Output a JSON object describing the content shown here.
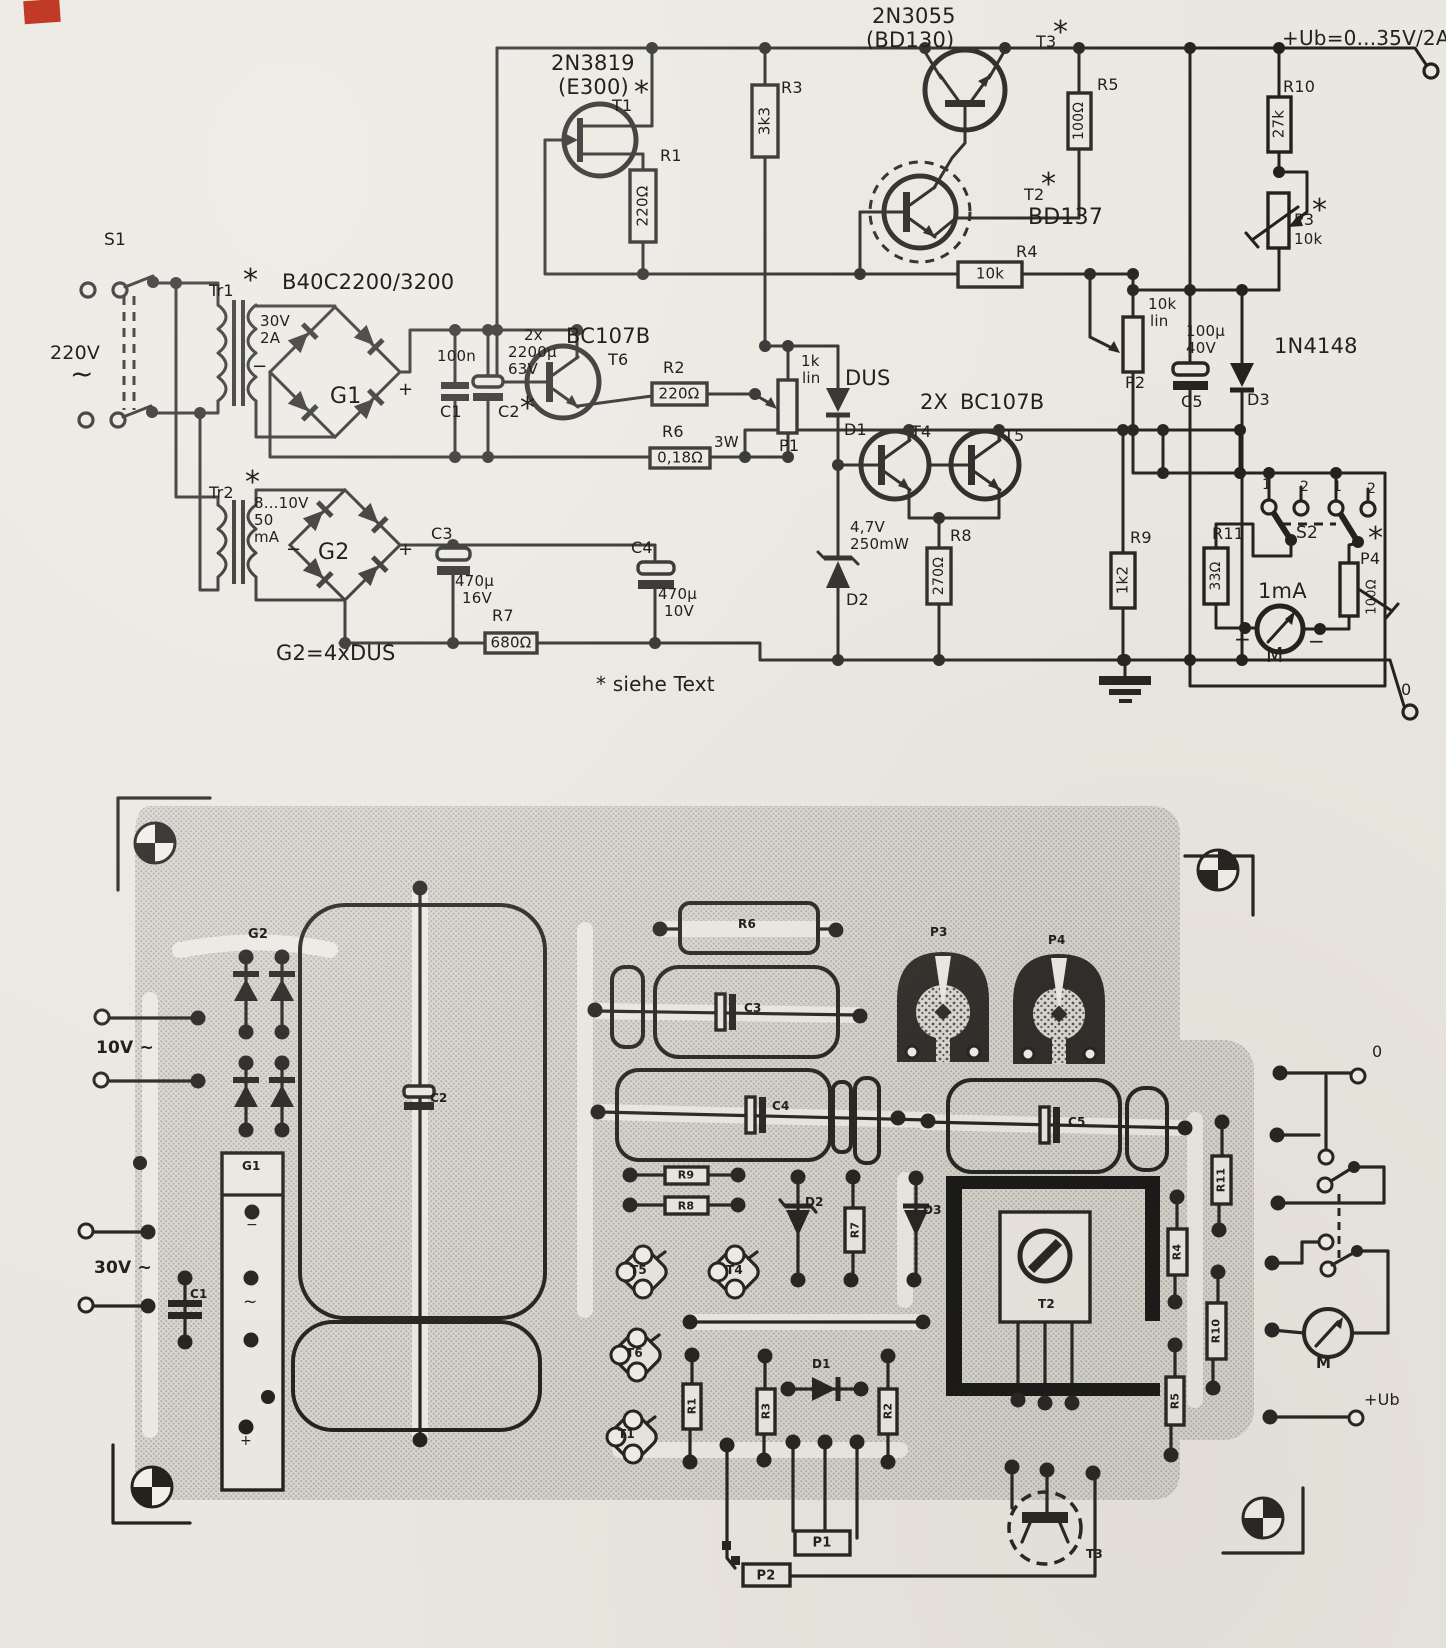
{
  "meta": {
    "content_type": "scanned circuit schematic with PCB layout",
    "paper_color": "#eae7e0",
    "ink_color": "#22211e",
    "board_color": "#d7d5ce",
    "artifact_color": "#c03a25"
  },
  "schematic": {
    "labels": [
      {
        "n": "s1-label",
        "t": "S1",
        "x": 104,
        "y": 232,
        "fs": 17
      },
      {
        "n": "mains-voltage",
        "t": "220V",
        "x": 50,
        "y": 344,
        "fs": 19
      },
      {
        "n": "mains-ac-symbol",
        "t": "~",
        "x": 70,
        "y": 360,
        "fs": 28
      },
      {
        "n": "tr1-label",
        "t": "Tr1",
        "x": 209,
        "y": 283,
        "fs": 16
      },
      {
        "n": "tr1-star",
        "t": "*",
        "x": 243,
        "y": 266,
        "fs": 30
      },
      {
        "n": "tr2-label",
        "t": "Tr2",
        "x": 209,
        "y": 485,
        "fs": 16
      },
      {
        "n": "tr2-star",
        "t": "*",
        "x": 245,
        "y": 468,
        "fs": 30
      },
      {
        "n": "bridge1-part",
        "t": "B40C2200/3200",
        "x": 282,
        "y": 272,
        "fs": 21
      },
      {
        "n": "g1-volt",
        "t": "30V",
        "x": 260,
        "y": 314,
        "fs": 15
      },
      {
        "n": "g1-amp",
        "t": "2A",
        "x": 260,
        "y": 331,
        "fs": 15
      },
      {
        "n": "g1-minus",
        "t": "−",
        "x": 252,
        "y": 358,
        "fs": 18
      },
      {
        "n": "g1-label",
        "t": "G1",
        "x": 330,
        "y": 386,
        "fs": 22
      },
      {
        "n": "g1-plus",
        "t": "+",
        "x": 398,
        "y": 381,
        "fs": 18
      },
      {
        "n": "g2-volt",
        "t": "8...10V",
        "x": 254,
        "y": 496,
        "fs": 15
      },
      {
        "n": "g2-cur",
        "t": "50",
        "x": 254,
        "y": 513,
        "fs": 15
      },
      {
        "n": "g2-cur-unit",
        "t": "mA",
        "x": 254,
        "y": 530,
        "fs": 15
      },
      {
        "n": "g2-minus",
        "t": "−",
        "x": 286,
        "y": 541,
        "fs": 18
      },
      {
        "n": "g2-label",
        "t": "G2",
        "x": 318,
        "y": 542,
        "fs": 22
      },
      {
        "n": "g2-plus",
        "t": "+",
        "x": 398,
        "y": 541,
        "fs": 18
      },
      {
        "n": "c1-value",
        "t": "100n",
        "x": 437,
        "y": 349,
        "fs": 15
      },
      {
        "n": "c1-label",
        "t": "C1",
        "x": 440,
        "y": 404,
        "fs": 16
      },
      {
        "n": "c2-qty",
        "t": "2x",
        "x": 524,
        "y": 328,
        "fs": 15
      },
      {
        "n": "c2-value",
        "t": "2200µ",
        "x": 508,
        "y": 345,
        "fs": 15
      },
      {
        "n": "c2-volt",
        "t": "63V",
        "x": 508,
        "y": 362,
        "fs": 15
      },
      {
        "n": "c2-label",
        "t": "C2",
        "x": 498,
        "y": 404,
        "fs": 16
      },
      {
        "n": "c2-star",
        "t": "*",
        "x": 520,
        "y": 394,
        "fs": 30
      },
      {
        "n": "t6-part",
        "t": "BC107B",
        "x": 566,
        "y": 326,
        "fs": 21
      },
      {
        "n": "t6-label",
        "t": "T6",
        "x": 608,
        "y": 352,
        "fs": 16
      },
      {
        "n": "t1-part",
        "t": "2N3819",
        "x": 551,
        "y": 53,
        "fs": 21
      },
      {
        "n": "t1-part-alt",
        "t": "(E300)",
        "x": 558,
        "y": 77,
        "fs": 21
      },
      {
        "n": "t1-star",
        "t": "*",
        "x": 634,
        "y": 78,
        "fs": 30
      },
      {
        "n": "t1-label",
        "t": "T1",
        "x": 612,
        "y": 98,
        "fs": 16
      },
      {
        "n": "r1-label",
        "t": "R1",
        "x": 660,
        "y": 148,
        "fs": 16
      },
      {
        "n": "r1-value",
        "t": "220Ω",
        "x": 643,
        "y": 206,
        "fs": 15,
        "r": 1
      },
      {
        "n": "r3-label",
        "t": "R3",
        "x": 781,
        "y": 80,
        "fs": 16
      },
      {
        "n": "r3-value",
        "t": "3k3",
        "x": 765,
        "y": 121,
        "fs": 15,
        "r": 1
      },
      {
        "n": "t3-part",
        "t": "2N3055",
        "x": 872,
        "y": 6,
        "fs": 21
      },
      {
        "n": "t3-part-alt",
        "t": "(BD130)",
        "x": 866,
        "y": 30,
        "fs": 21
      },
      {
        "n": "t3-label",
        "t": "T3",
        "x": 1036,
        "y": 34,
        "fs": 16
      },
      {
        "n": "t3-star",
        "t": "*",
        "x": 1053,
        "y": 18,
        "fs": 30
      },
      {
        "n": "r5-label",
        "t": "R5",
        "x": 1097,
        "y": 77,
        "fs": 16
      },
      {
        "n": "r5-value",
        "t": "100Ω",
        "x": 1079,
        "y": 121,
        "fs": 14,
        "r": 1
      },
      {
        "n": "t2-label",
        "t": "T2",
        "x": 1024,
        "y": 187,
        "fs": 16
      },
      {
        "n": "t2-star",
        "t": "*",
        "x": 1041,
        "y": 170,
        "fs": 30
      },
      {
        "n": "t2-part",
        "t": "BD137",
        "x": 1028,
        "y": 207,
        "fs": 22
      },
      {
        "n": "r4-label",
        "t": "R4",
        "x": 1016,
        "y": 244,
        "fs": 16
      },
      {
        "n": "r4-value",
        "t": "10k",
        "x": 990,
        "y": 274,
        "fs": 15,
        "c": 1
      },
      {
        "n": "p2-value",
        "t": "10k",
        "x": 1148,
        "y": 297,
        "fs": 15
      },
      {
        "n": "p2-lin",
        "t": "lin",
        "x": 1150,
        "y": 314,
        "fs": 15
      },
      {
        "n": "p2-label",
        "t": "P2",
        "x": 1125,
        "y": 375,
        "fs": 16
      },
      {
        "n": "c5-value",
        "t": "100µ",
        "x": 1186,
        "y": 324,
        "fs": 15
      },
      {
        "n": "c5-volt",
        "t": "40V",
        "x": 1186,
        "y": 341,
        "fs": 15
      },
      {
        "n": "c5-label",
        "t": "C5",
        "x": 1181,
        "y": 394,
        "fs": 16
      },
      {
        "n": "d3-part",
        "t": "1N4148",
        "x": 1274,
        "y": 336,
        "fs": 21
      },
      {
        "n": "d3-label",
        "t": "D3",
        "x": 1247,
        "y": 392,
        "fs": 16
      },
      {
        "n": "r10-label",
        "t": "R10",
        "x": 1283,
        "y": 79,
        "fs": 16
      },
      {
        "n": "r10-value",
        "t": "27k",
        "x": 1279,
        "y": 124,
        "fs": 15,
        "r": 1
      },
      {
        "n": "p3-label",
        "t": "P3",
        "x": 1294,
        "y": 212,
        "fs": 16
      },
      {
        "n": "p3-star",
        "t": "*",
        "x": 1312,
        "y": 196,
        "fs": 30
      },
      {
        "n": "p3-value",
        "t": "10k",
        "x": 1294,
        "y": 232,
        "fs": 15
      },
      {
        "n": "ub-label",
        "t": "+Ub=0...35V/2A",
        "x": 1282,
        "y": 28,
        "fs": 20
      },
      {
        "n": "r2-label",
        "t": "R2",
        "x": 663,
        "y": 360,
        "fs": 16
      },
      {
        "n": "r2-value",
        "t": "220Ω",
        "x": 679,
        "y": 394,
        "fs": 15,
        "c": 1
      },
      {
        "n": "r6-label",
        "t": "R6",
        "x": 662,
        "y": 424,
        "fs": 16
      },
      {
        "n": "r6-value",
        "t": "0,18Ω",
        "x": 680,
        "y": 458,
        "fs": 15,
        "c": 1
      },
      {
        "n": "r6-watt",
        "t": "3W",
        "x": 714,
        "y": 435,
        "fs": 15
      },
      {
        "n": "p1-value",
        "t": "1k",
        "x": 801,
        "y": 354,
        "fs": 15
      },
      {
        "n": "p1-lin",
        "t": "lin",
        "x": 802,
        "y": 371,
        "fs": 15
      },
      {
        "n": "p1-label",
        "t": "P1",
        "x": 779,
        "y": 438,
        "fs": 16
      },
      {
        "n": "d1-part",
        "t": "DUS",
        "x": 845,
        "y": 368,
        "fs": 21
      },
      {
        "n": "d1-label",
        "t": "D1",
        "x": 844,
        "y": 422,
        "fs": 16
      },
      {
        "n": "t45-qty",
        "t": "2X",
        "x": 920,
        "y": 392,
        "fs": 21
      },
      {
        "n": "t45-part",
        "t": "BC107B",
        "x": 960,
        "y": 392,
        "fs": 21
      },
      {
        "n": "t4-label",
        "t": "T4",
        "x": 911,
        "y": 424,
        "fs": 16
      },
      {
        "n": "t5-label",
        "t": "T5",
        "x": 1004,
        "y": 428,
        "fs": 16
      },
      {
        "n": "d2-volt",
        "t": "4,7V",
        "x": 850,
        "y": 520,
        "fs": 15
      },
      {
        "n": "d2-power",
        "t": "250mW",
        "x": 850,
        "y": 537,
        "fs": 15
      },
      {
        "n": "d2-label",
        "t": "D2",
        "x": 846,
        "y": 592,
        "fs": 16
      },
      {
        "n": "r8-label",
        "t": "R8",
        "x": 950,
        "y": 528,
        "fs": 16
      },
      {
        "n": "r8-value",
        "t": "270Ω",
        "x": 939,
        "y": 576,
        "fs": 14,
        "r": 1
      },
      {
        "n": "r9-label",
        "t": "R9",
        "x": 1130,
        "y": 530,
        "fs": 16
      },
      {
        "n": "r9-value",
        "t": "1k2",
        "x": 1123,
        "y": 580,
        "fs": 15,
        "r": 1
      },
      {
        "n": "s2-label",
        "t": "S2",
        "x": 1296,
        "y": 525,
        "fs": 17
      },
      {
        "n": "s2-pos-1a",
        "t": "1",
        "x": 1262,
        "y": 478,
        "fs": 14
      },
      {
        "n": "s2-pos-2a",
        "t": "2",
        "x": 1300,
        "y": 480,
        "fs": 14
      },
      {
        "n": "s2-pos-1b",
        "t": "1",
        "x": 1333,
        "y": 480,
        "fs": 14
      },
      {
        "n": "s2-pos-2b",
        "t": "2",
        "x": 1367,
        "y": 482,
        "fs": 14
      },
      {
        "n": "r11-label",
        "t": "R11",
        "x": 1212,
        "y": 526,
        "fs": 16
      },
      {
        "n": "r11-value",
        "t": "33Ω",
        "x": 1216,
        "y": 576,
        "fs": 14,
        "r": 1
      },
      {
        "n": "meter-range",
        "t": "1mA",
        "x": 1258,
        "y": 581,
        "fs": 21
      },
      {
        "n": "meter-label",
        "t": "M",
        "x": 1266,
        "y": 645,
        "fs": 20
      },
      {
        "n": "meter-plus",
        "t": "+",
        "x": 1234,
        "y": 629,
        "fs": 20
      },
      {
        "n": "meter-minus",
        "t": "−",
        "x": 1308,
        "y": 631,
        "fs": 20
      },
      {
        "n": "p4-label",
        "t": "P4",
        "x": 1360,
        "y": 551,
        "fs": 16
      },
      {
        "n": "p4-star",
        "t": "*",
        "x": 1368,
        "y": 524,
        "fs": 30
      },
      {
        "n": "p4-value",
        "t": "100Ω",
        "x": 1372,
        "y": 597,
        "fs": 13,
        "r": 1
      },
      {
        "n": "r7-label",
        "t": "R7",
        "x": 492,
        "y": 608,
        "fs": 16
      },
      {
        "n": "r7-value",
        "t": "680Ω",
        "x": 511,
        "y": 643,
        "fs": 15,
        "c": 1
      },
      {
        "n": "g2-note",
        "t": "G2=4xDUS",
        "x": 276,
        "y": 643,
        "fs": 21
      },
      {
        "n": "note-siehe-text",
        "t": "* siehe Text",
        "x": 596,
        "y": 674,
        "fs": 20
      },
      {
        "n": "out-zero-label",
        "t": "0",
        "x": 1401,
        "y": 682,
        "fs": 16
      },
      {
        "n": "c3-label",
        "t": "C3",
        "x": 431,
        "y": 526,
        "fs": 16
      },
      {
        "n": "c3-value",
        "t": "470µ",
        "x": 455,
        "y": 574,
        "fs": 15
      },
      {
        "n": "c3-volt",
        "t": "16V",
        "x": 462,
        "y": 591,
        "fs": 15
      },
      {
        "n": "c4-label",
        "t": "C4",
        "x": 631,
        "y": 540,
        "fs": 16
      },
      {
        "n": "c4-value",
        "t": "470µ",
        "x": 658,
        "y": 587,
        "fs": 15
      },
      {
        "n": "c4-volt",
        "t": "10V",
        "x": 664,
        "y": 604,
        "fs": 15
      }
    ]
  },
  "pcb": {
    "labels": [
      {
        "n": "pcb-g2-label",
        "t": "G2",
        "x": 248,
        "y": 928,
        "fs": 13,
        "b": 1
      },
      {
        "n": "pcb-10v-label",
        "t": "10V ~",
        "x": 96,
        "y": 1040,
        "fs": 17,
        "b": 1
      },
      {
        "n": "pcb-30v-label",
        "t": "30V ~",
        "x": 94,
        "y": 1260,
        "fs": 17,
        "b": 1
      },
      {
        "n": "pcb-c1-label",
        "t": "C1",
        "x": 190,
        "y": 1288,
        "fs": 12,
        "b": 1
      },
      {
        "n": "pcb-g1-label",
        "t": "G1",
        "x": 242,
        "y": 1160,
        "fs": 12,
        "b": 1
      },
      {
        "n": "pcb-g1-minus",
        "t": "−",
        "x": 246,
        "y": 1218,
        "fs": 14
      },
      {
        "n": "pcb-g1-ac",
        "t": "~",
        "x": 243,
        "y": 1294,
        "fs": 17
      },
      {
        "n": "pcb-g1-plus",
        "t": "+",
        "x": 240,
        "y": 1434,
        "fs": 14
      },
      {
        "n": "pcb-c2-label",
        "t": "C2",
        "x": 430,
        "y": 1092,
        "fs": 12,
        "b": 1
      },
      {
        "n": "pcb-r6-label",
        "t": "R6",
        "x": 738,
        "y": 918,
        "fs": 12,
        "b": 1
      },
      {
        "n": "pcb-c3-label",
        "t": "C3",
        "x": 744,
        "y": 1002,
        "fs": 12,
        "b": 1
      },
      {
        "n": "pcb-p3-label",
        "t": "P3",
        "x": 930,
        "y": 926,
        "fs": 12,
        "b": 1
      },
      {
        "n": "pcb-p4-label",
        "t": "P4",
        "x": 1048,
        "y": 934,
        "fs": 12,
        "b": 1
      },
      {
        "n": "pcb-c4-label",
        "t": "C4",
        "x": 772,
        "y": 1100,
        "fs": 12,
        "b": 1
      },
      {
        "n": "pcb-r9-label",
        "t": "R9",
        "x": 686,
        "y": 1175,
        "fs": 11,
        "b": 1,
        "c": 1
      },
      {
        "n": "pcb-r8-label",
        "t": "R8",
        "x": 686,
        "y": 1206,
        "fs": 11,
        "b": 1,
        "c": 1
      },
      {
        "n": "pcb-d2-label",
        "t": "D2",
        "x": 805,
        "y": 1196,
        "fs": 12,
        "b": 1
      },
      {
        "n": "pcb-r7-label",
        "t": "R7",
        "x": 855,
        "y": 1230,
        "fs": 11,
        "b": 1,
        "r": 1
      },
      {
        "n": "pcb-d3-label",
        "t": "D3",
        "x": 923,
        "y": 1204,
        "fs": 12,
        "b": 1
      },
      {
        "n": "pcb-c5-label",
        "t": "C5",
        "x": 1068,
        "y": 1116,
        "fs": 12,
        "b": 1
      },
      {
        "n": "pcb-r11-label",
        "t": "R11",
        "x": 1221,
        "y": 1180,
        "fs": 11,
        "b": 1,
        "r": 1
      },
      {
        "n": "pcb-r4-label",
        "t": "R4",
        "x": 1177,
        "y": 1252,
        "fs": 11,
        "b": 1,
        "r": 1
      },
      {
        "n": "pcb-r10-label",
        "t": "R10",
        "x": 1216,
        "y": 1331,
        "fs": 11,
        "b": 1,
        "r": 1
      },
      {
        "n": "pcb-r5-label",
        "t": "R5",
        "x": 1175,
        "y": 1401,
        "fs": 11,
        "b": 1,
        "r": 1
      },
      {
        "n": "pcb-t5-label",
        "t": "T5",
        "x": 630,
        "y": 1264,
        "fs": 12,
        "b": 1
      },
      {
        "n": "pcb-t4-label",
        "t": "T4",
        "x": 726,
        "y": 1264,
        "fs": 12,
        "b": 1
      },
      {
        "n": "pcb-t6-label",
        "t": "T6",
        "x": 626,
        "y": 1347,
        "fs": 12,
        "b": 1
      },
      {
        "n": "pcb-t1-label",
        "t": "T1",
        "x": 618,
        "y": 1428,
        "fs": 12,
        "b": 1
      },
      {
        "n": "pcb-r1-label",
        "t": "R1",
        "x": 692,
        "y": 1406,
        "fs": 11,
        "b": 1,
        "r": 1
      },
      {
        "n": "pcb-r3-label",
        "t": "R3",
        "x": 766,
        "y": 1411,
        "fs": 11,
        "b": 1,
        "r": 1
      },
      {
        "n": "pcb-d1-label",
        "t": "D1",
        "x": 812,
        "y": 1358,
        "fs": 12,
        "b": 1
      },
      {
        "n": "pcb-r2-label",
        "t": "R2",
        "x": 888,
        "y": 1411,
        "fs": 11,
        "b": 1,
        "r": 1
      },
      {
        "n": "pcb-t2-label",
        "t": "T2",
        "x": 1038,
        "y": 1298,
        "fs": 12,
        "b": 1
      },
      {
        "n": "pcb-p1-label",
        "t": "P1",
        "x": 822,
        "y": 1543,
        "fs": 13,
        "b": 1,
        "c": 1
      },
      {
        "n": "pcb-p2-label",
        "t": "P2",
        "x": 766,
        "y": 1576,
        "fs": 13,
        "b": 1,
        "c": 1
      },
      {
        "n": "pcb-t3-label",
        "t": "T3",
        "x": 1086,
        "y": 1548,
        "fs": 12,
        "b": 1
      },
      {
        "n": "pcb-out0-label",
        "t": "0",
        "x": 1372,
        "y": 1044,
        "fs": 16
      },
      {
        "n": "pcb-m-label",
        "t": "M",
        "x": 1316,
        "y": 1356,
        "fs": 15,
        "b": 1
      },
      {
        "n": "pcb-ub-label",
        "t": "+Ub",
        "x": 1364,
        "y": 1392,
        "fs": 16
      }
    ]
  }
}
